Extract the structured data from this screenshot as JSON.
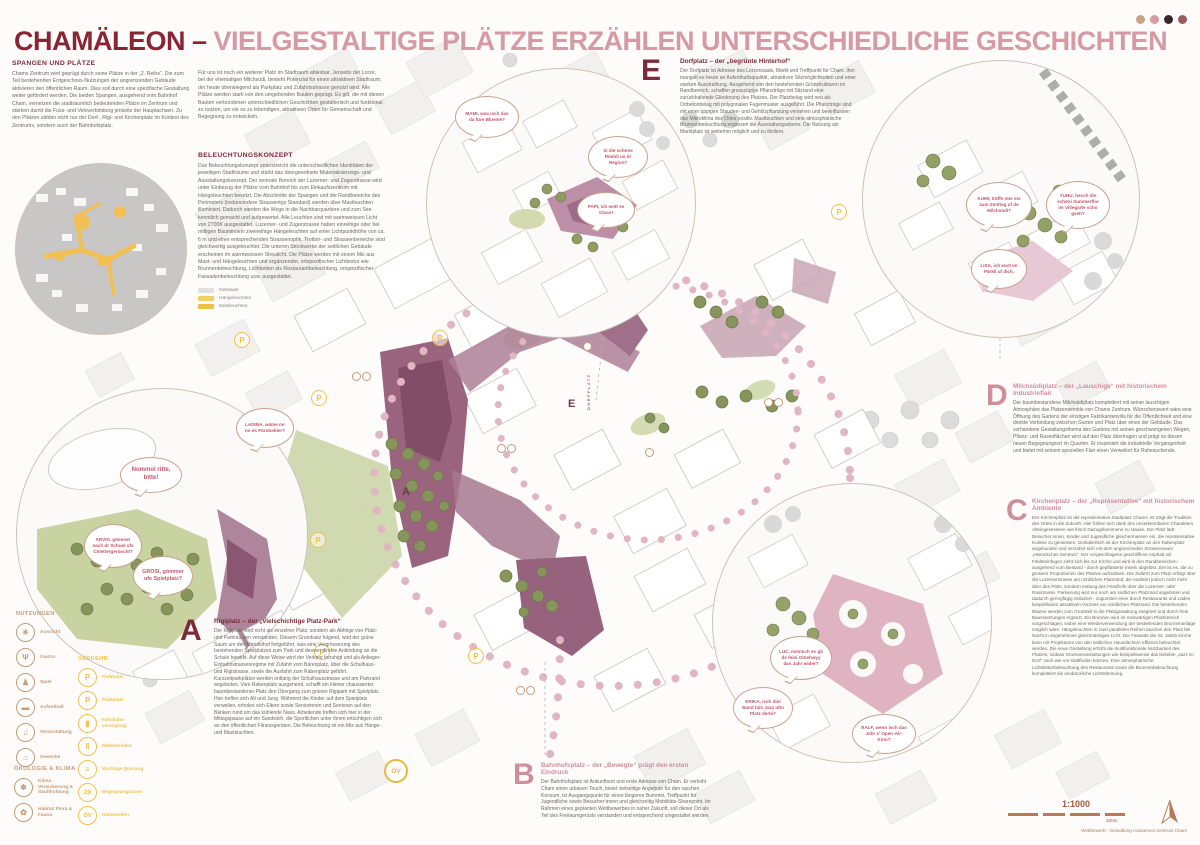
{
  "header": {
    "title_primary": "CHAMÄLEON –",
    "title_secondary": "VIELGESTALTIGE PLÄTZE ERZÄHLEN UNTERSCHIEDLICHE GESCHICHTEN"
  },
  "intro": {
    "heading": "SPANGEN UND PLÄTZE",
    "col1": "Chams Zentrum wird geprägt durch seine Plätze in der „2. Reihe“. Die zum Teil bestehenden Erdgeschoss-Nutzungen der angrenzenden Gebäude aktivieren den öffentlichen Raum. Dies soll durch eine spezifische Gestaltung weiter gefördert werden. Die beiden Spangen, ausgehend vom Bahnhof Cham, vernetzen die stadträumlich bedeutenden Plätze im Zentrum und stärken damit die Fuss- und Veloverbindung jenseits der Hauptachsen. Zu den Plätzen zählen nicht nur der Dorf-, Rigi- und Kirchenplatz im Kontext des Zentrums, sondern auch der Bahnhofsplatz.",
    "col2": "Für uns ist noch ein weiterer Platz im Stadtraum ablesbar. Jenseits der Lorze, bei der ehemaligen Milchsüdi, besteht Potenzial für einen attraktiven Stadtraum, der heute überwiegend als Parkplatz und Zufahrtsstrasse genutzt wird. Alle Plätze werden stark von den umgebenden Bauten geprägt. Es gilt, die mit diesen Bauten verbundenen unterschiedlichen Geschichten gestalterisch und funktional zu nutzen, um sie so zu lebendigen, attraktiven Orten für Gemeinschaft und Begegnung zu entwickeln."
  },
  "lighting": {
    "heading": "BELEUCHTUNGSKONZEPT",
    "body": "Das Beleuchtungskonzept unterstreicht die unterschiedlichen Identitäten der jeweiligen Stadträume und stärkt das übergeordnete Materialisierungs- und Ausstattungskonzept. Der zentrale Bereich der Luzerner- und Zugerstrasse wird unter Einbezug der Plätze vom Bahnhof bis zum Einkaufszentrum mit Hängeleuchten besetzt. Die Abschnitte der Spangen und die Randbereiche des Perimeters (insbesondere Strassentyp Standard) werden über Mastleuchten illuminiert. Dadurch werden die Wege in die Nachbarquartiere und zum See kenntlich gemacht und aufgewertet. Alle Leuchten sind mit warmweissen Licht von 2700K ausgestattet. Luzerner- und Zugerstrasse haben einreihige oder bei mittigen Bauminseln zweireihige Hängeleuchten auf einer Lichtpunkthöhe von ca. 6 m und einer entsprechenden Strassenoptik. Trottoir- und Strassenbereiche sind gleichwertig ausgeleuchtet. Die unteren Stockwerke der seitlichen Gebäude erscheinen im warmweissen Streulicht. Die Plätze werden mit einem Mix aus Mast- und Hängeleuchten und ergänzender, ortspezifischer Lichttextur wie Brunnenbeleuchtung, Lichtketten als Restaurantbeleuchtung, ortspezifischer Fassadenbeleuchtung usw. ausgestattet.",
    "legend": [
      {
        "label": "Gebäude",
        "color": "#e2e0dd"
      },
      {
        "label": "Hängeleuchten",
        "color": "#f3cd6b"
      },
      {
        "label": "Mastleuchten",
        "color": "#edbf4b"
      }
    ]
  },
  "sections": {
    "a": {
      "letter": "A",
      "title": "Rigiplatz – der „vielschichtige Platz-Park“",
      "body": "Der Rigiplatz wird nicht als einzelner Platz, sondern als Abfolge von Platz- und Parkräumen verstanden. Diesem Grundsatz folgend, wird der grüne Saum um den Mandelhof fortgeführt, was eine Vergrösserung des bestehenden Spielplatzes zum Park und dessen direkte Anbindung an die Schule bewirkt. Auf diese Weise wird der Verkehr beruhigt und als Anlieger-Einbahnstrassenregime mit Zufahrt vom Bärenplatz, über die Schulhaus- und Rigistrasse, sowie die Ausfahrt zum Rabenplatz geführt. Kurzzeitparkplätze werden entlang der Schulhausstrasse und am Parkrand angeboten. Vom Rabenplatz ausgehend, schafft ein kleiner chaussierter, baumbestandener Platz den Übergang zum grünen Rigipark mit Spielplatz. Hier treffen sich Alt und Jung. Während die Kinder auf dem Spielplatz verweilen, erholen sich Eltern sowie Seniorinnen und Senioren auf den Bänken rund um das kühlende Nass. Arbeitende treffen sich hier in der Mittagspause auf ein Sandwich, die Sportlichen unter ihnen ertüchtigen sich an den öffentlichen Fitnessgeräten. Die Beleuchtung ist ein Mix aus Hänge- und Mastleuchten."
    },
    "b": {
      "letter": "B",
      "title": "Bahnhofsplatz – der „Bewegte“ prägt den ersten Eindruck",
      "body": "Der Bahnhofsplatz ist Ankunftsort und erste Adresse von Cham. Er verleiht Cham einen urbanen Touch, bietet vielseitige Angebote für den raschen Konsum, ist Ausgangspunkt für einen längeren Bummel, Treffpunkt für Jugendliche sowie Besucher:innen und gleichzeitig Mobilitäts-Sharepoint. Im Rahmen eines geplanten Wettbewerbes in naher Zukunft, soll dieser Ort als Teil des Freiraumgerüsts verstanden und entsprechend umgestaltet werden."
    },
    "c": {
      "letter": "C",
      "title": "Kirchenplatz – der „Repräsentative“ mit historischem Ambiente",
      "body": "Der Kirchenplatz ist der repräsentative Stadtplatz Chams. Er trägt die Tradition des Ortes in die Zukunft. Hier fühlen sich dank des unverkennbaren Charakters Alteingesessene wie frisch Dazugekommene zu Hause. Der Platz lädt Besucher:innen, Kinder und Jugendliche gleichermassen ein, die repräsentative Kulisse zu geniessen. Gestalterisch ist der Kirchenplatz an den Rabenplatz angebunden und verzahnt sich mit dem angrenzenden Strassenraum „Historisches Zentrum“. Der vorgeschlagene geschliffene Asphalt mit Feldsteinfugen zieht sich bis zur Kirche und wird in den Randbereichen - ausgehend vom Bestand - durch gepflasterte Inseln abgelöst. Ziel ist es, die zu grossen Proportionen des Platzes aufzulösen. Die Zufahrt zum Platz erfolgt über die Luzernerstrasse am nördlichen Platzrand, die Ausfahrt jedoch nicht mehr über den Platz, sondern entlang des Friedhofs über die Luzerner- oder Rasstrasse. Parkierung wird nur noch am südlichen Platzrand angeboten und dadurch geringfügig reduziert - zugunsten einer durch Restaurants und Läden bespielbaren attraktiven Vorzone am nördlichen Platzrand. Die bestehenden Bäume werden zum Grossteil in die Platzgestaltung integriert und durch freie Baumsetzungen ergänzt. Ein Brunnen wird im rückwärtigen Platzbereich vorgeschlagen, wobei eine Wiederverwendung der bestehenden Brunnenanlage möglich wäre. Hängeleuchten in zwei parallelen Reihen tauchen den Platz bei Nacht in angenehmes gleichmässiges Licht. Die Fassade der St. Jakob Kirche kann mit Projektoren von den seitlichen Hausdächern effizient beleuchtet werden. Die neue Gestaltung erhöht die multifunktionale Nutzbarkeit des Platzes, sodass Grossveranstaltungen wie beispielsweise das beliebte „Jazz im Dorf“ nach wie vor stattfinden können. Eine atmosphärische Lichtkettenbeleuchtung des Restaurants sowie die Brunnenbeleuchtung komplettiert die eindrückliche Lichtstimmung."
    },
    "d": {
      "letter": "D",
      "title": "Milchsüdiplatz – der „Lauschige“ mit historischem Industrieflair",
      "body": "Der baumbestandene Milchsüdiplatz komplettiert mit seiner lauschigen Atmosphäre das Platzensemble von Chams Zentrum. Wünschenswert wäre eine Öffnung des Gartens der einstigen Fabrikantenvilla für die Öffentlichkeit und eine direkte Verbindung zwischen Garten und Platz über eines der Gebäude. Das vorhandene Gestaltungsthema des Gartens mit seinen geschwungenen Wegen, Pflanz- und Rasenflächen wird auf den Platz übertragen und prägt so diesen neuen Begegnungsort im Quartier. Er inszeniert die industrielle Vergangenheit und bietet mit seinem speziellen Flair einen Verweilort für Ruhesuchende."
    },
    "e": {
      "letter": "E",
      "title": "Dorfplatz – der „begrünte Hinterhof“",
      "body": "Der Dorfplatz ist Adresse des Lorzensaals, Markt und Treffpunkt für Cham. Ihm mangelt es heute an Aufenthaltsqualität, attraktiven Sitzmöglichkeiten und einer starken Ausstrahlung. Ausgehend von den bestehenden Grünstrukturen im Randbereich, schaffen grosszügige Pflanztröge mit Sitzrand eine zurückhaltende Gliederung des Platzes. Der Platzbelag wird neu als Ortbetonbelag mit polygonalen Fugenmuster ausgeführt. Die Pflanztröge sind mit einer üppigen Stauden- und Gehölzpflanzung versehen und beeinflussen das Mikroklima des Ortes positiv. Mastleuchten und eine atmosphärische Brunnenbeleuchtung ergänzen die Ausstattungsebene. Die Nutzung als Marktplatz ist weiterhin möglich und zu fördern."
    }
  },
  "bubbles": {
    "e1": "MAMI, was isch das da füre Blueme?",
    "e2": "Si die schöne Rüebli us dr Region?",
    "e3": "PAPI, ich wott es Glace!",
    "d1": "KUMI, träffe mer eis zum Zmittag uf de Milchsüdi?",
    "d2": "YUHU, hesch die schöni Summerflor im Villegarte scho gseh?",
    "d3": "LISA, ich wart im Pärkli uf dich.",
    "a1": "LADINA, wäme mr no es Fürobebier?",
    "a2": "Nommol ritte, bitte!",
    "a3": "ARVID, gömmer nach dr Schuel ufs Chlettergerüscht?",
    "a4": "GROSI, gömmer ufe Spielplatz?",
    "c1": "LUC, meinsch es git de feini Glüehwyy das Jahr wider?",
    "c2": "ERIKA, isch dini Band bim Jazz ufm Platz derbi?",
    "c3": "RALF, wenn isch das Jahr s' Open-Air-Kino?"
  },
  "legend": {
    "nutzungen": {
      "heading": "NUTZUNGEN",
      "items": [
        {
          "label": "Aussicht",
          "glyph": "☀"
        },
        {
          "label": "Gastro",
          "glyph": "Ψ"
        },
        {
          "label": "Spiel",
          "glyph": "♟"
        },
        {
          "label": "Aufenthalt",
          "glyph": "▬"
        },
        {
          "label": "Veranstaltung",
          "glyph": "♫"
        },
        {
          "label": "Gewerbe",
          "glyph": "⌂"
        }
      ]
    },
    "verkehr": {
      "heading": "VERKEHR",
      "items": [
        {
          "label": "Parkhaus",
          "glyph": "P"
        },
        {
          "label": "Parkplatz",
          "glyph": "P"
        },
        {
          "label": "Fahrbahn- verengung",
          "glyph": "▮"
        },
        {
          "label": "Mittelstreifen",
          "glyph": "‖"
        },
        {
          "label": "Wichtige Querung",
          "glyph": "≡"
        },
        {
          "label": "Begegnungszone",
          "glyph": "20"
        },
        {
          "label": "Haltestellen",
          "glyph": "ÖV"
        }
      ]
    },
    "oekologie": {
      "heading": "ÖKOLOGIE & KLIMA",
      "items": [
        {
          "label": "Klima Versickerung & Stadtkühlung",
          "glyph": "❄"
        },
        {
          "label": "Habitat Flora & Fauna",
          "glyph": "✿"
        }
      ]
    }
  },
  "map": {
    "p_badge": "P",
    "ov_badge": "ÖV",
    "labels": {
      "rigiplatz": "RIGIPLATZ",
      "dorfplatz": "DORFPLATZ"
    },
    "markers": {
      "a": "A",
      "e": "E"
    }
  },
  "footer": {
    "scale": "1:1000",
    "scale_unit": "100m",
    "credit": "Wettbewerb - Gestaltung Autoarmes Zentrum Cham"
  },
  "colors": {
    "accent_dark": "#7d2b3a",
    "accent_pink": "#d59aa4",
    "accent_yellow": "#eec153",
    "accent_brown": "#c49a78",
    "plaza_purple": "#935f78",
    "park_green": "#ccd5a9"
  }
}
